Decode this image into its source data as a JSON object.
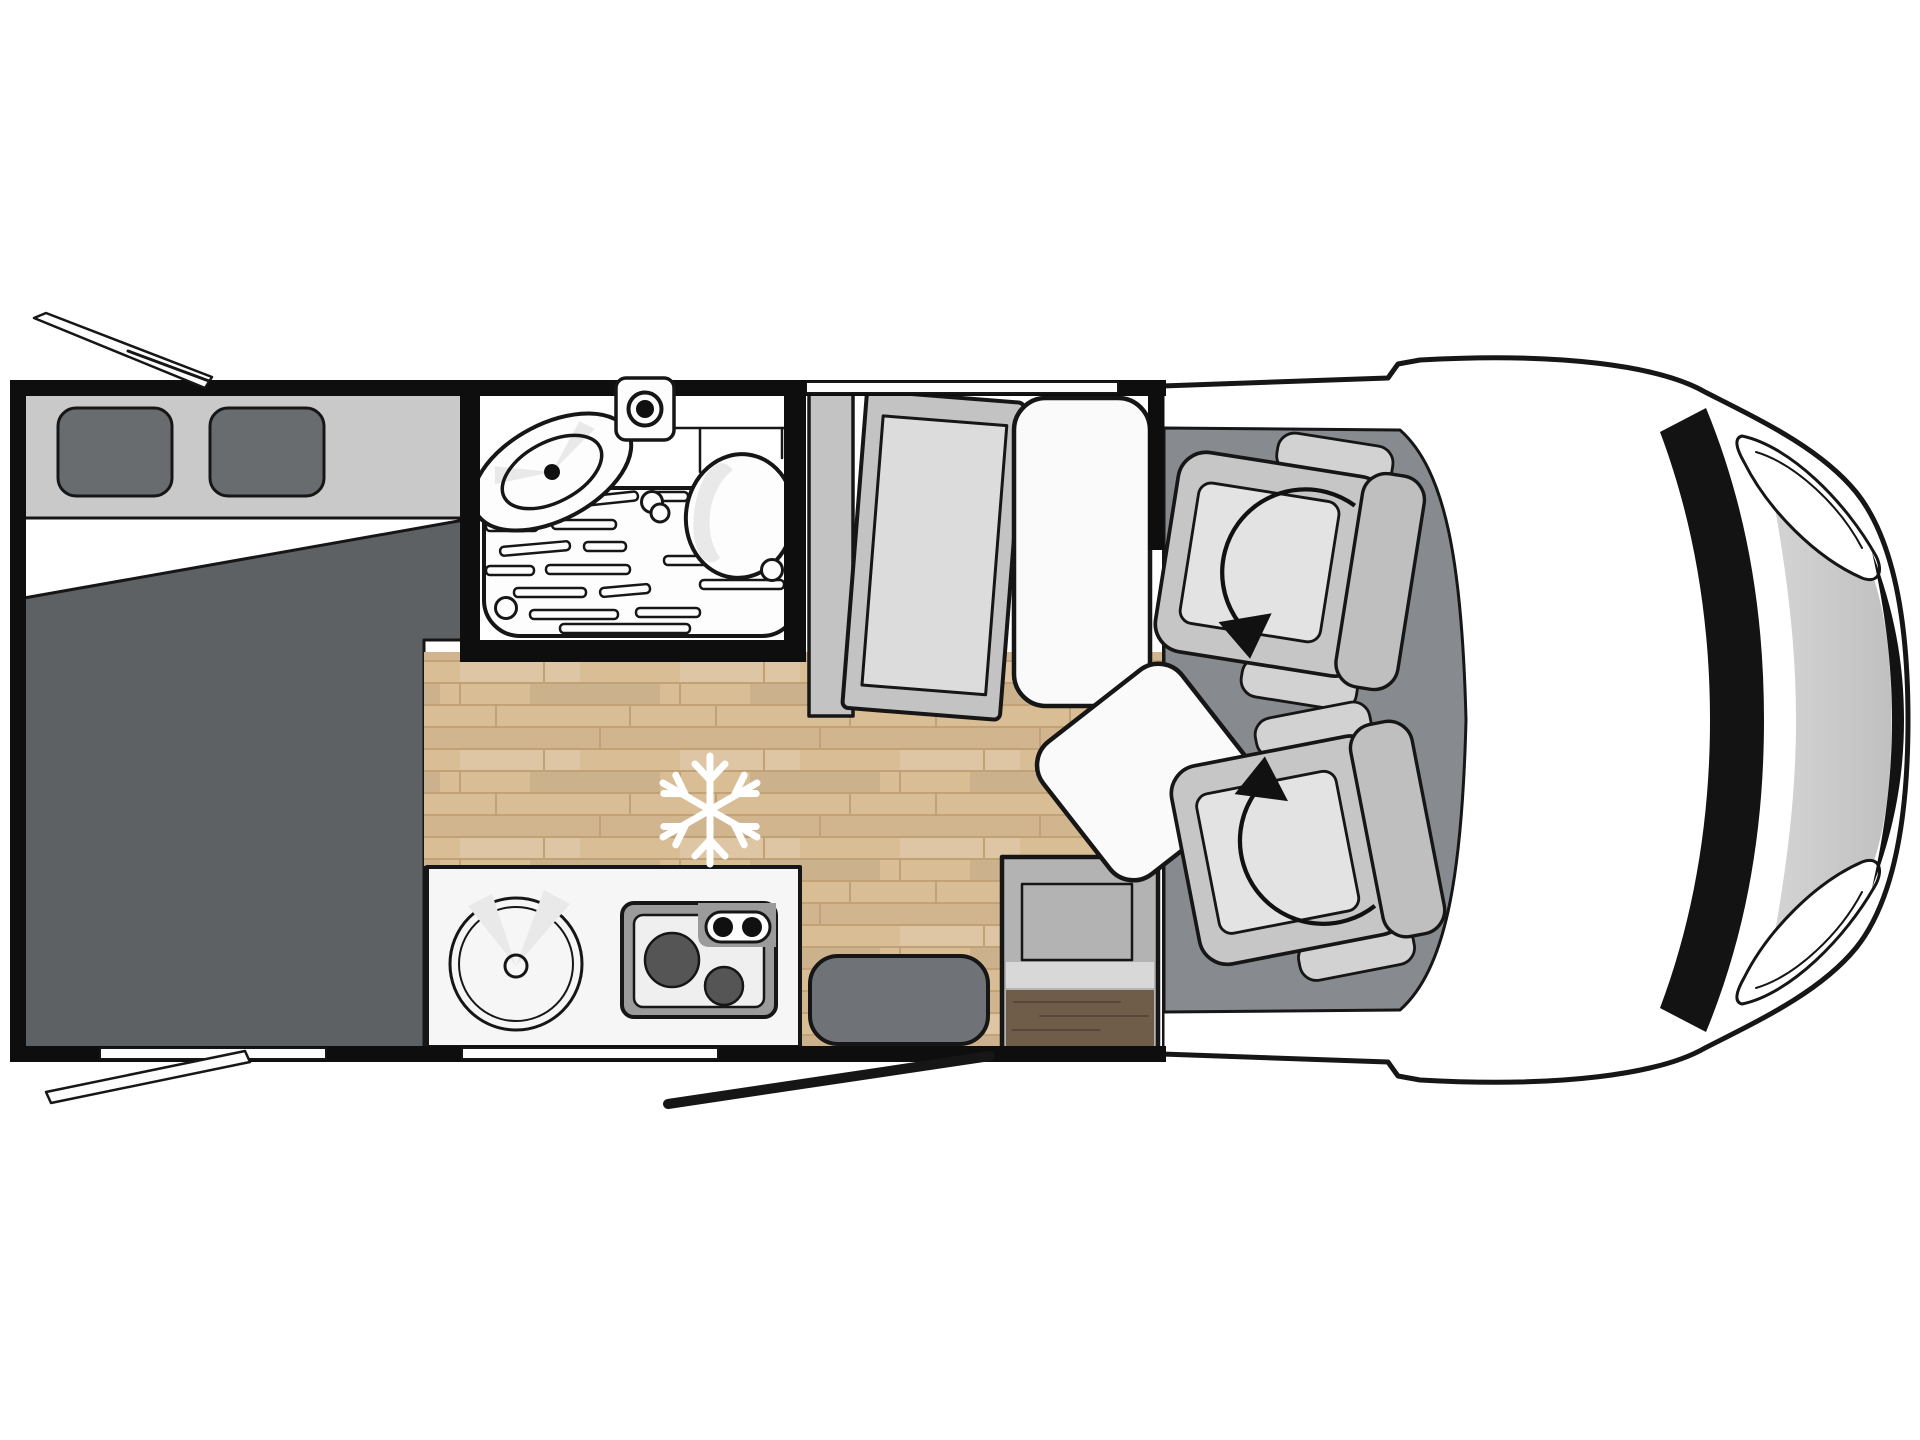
{
  "figure": {
    "type": "floorplan-diagram",
    "subject": "motorhome top view layout",
    "orientation": "vehicle front at right, rear at left"
  },
  "colors": {
    "background": "#ffffff",
    "outline": "#161616",
    "wall": "#0e0e0e",
    "interior": "#ffffff",
    "fixture": "#fdfdfd",
    "bed_headboard": "#c9c9c9",
    "pillow": "#686c6f",
    "bed_duvet": "#5d6164",
    "wood_base": "#d9bd95",
    "wood_line": "#c1a277",
    "cab_floor": "#878b8f",
    "bench": "#fafafa",
    "table": "#fafafa",
    "wardrobe": "#c3c3c3",
    "wardrobe_inner": "#dcdcdc",
    "kitchen_counter": "#f6f6f6",
    "hob": "#9b9b9b",
    "hob_inner": "#efefef",
    "burner": "#555555",
    "knob": "#101010",
    "entry_door": "#6f7276",
    "cabinet": "#b3b3b3",
    "cabinet_band": "#d8d8d8",
    "cabinet_wood": "#6f5c49",
    "cabinet_wood_line": "#57483a",
    "body_light": "#fafafa",
    "body_dark": "#cfcfcf",
    "hood_light": "#e3e3e3",
    "hood_dark": "#bfbfbf",
    "windshield": "#131313",
    "headlight": "#ffffff",
    "shade": "#e9e9e9",
    "seat_base": "#c6c6c6",
    "seat_back": "#bfbfbf",
    "seat_arm": "#d2d2d2",
    "seat_cushion": "#e3e3e3",
    "swivel": "#111111",
    "snowflake": "#ffffff"
  },
  "icons": {
    "snowflake": "snowflake-icon (cold zone / refrigerator position marker)",
    "swivel_arrows": "rotate-arrow-icon (swivelling cab seats)"
  },
  "components": [
    "rear-transverse-bed",
    "bed-pillows",
    "awning-arm-top",
    "awning-arm-bottom",
    "washroom",
    "toilet",
    "washbasin",
    "shower-tray",
    "roof-vent",
    "wardrobe",
    "bench-seat",
    "dinette-table",
    "snowflake-marker",
    "kitchen-unit",
    "round-sink",
    "two-burner-hob",
    "entrance-door",
    "door-swing-line",
    "entry-cabinet",
    "cab-floor",
    "driver-swivel-seat",
    "passenger-swivel-seat",
    "vehicle-front-body",
    "windshield",
    "headlight-top",
    "headlight-bottom",
    "front-bumper-shadow",
    "rear-window",
    "kitchen-window",
    "dinette-window"
  ]
}
